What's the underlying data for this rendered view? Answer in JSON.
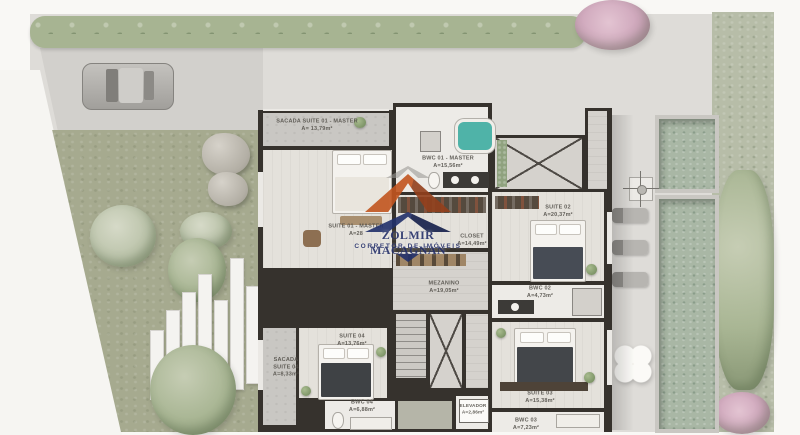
{
  "watermark": {
    "name": "ZOLMIR MACAGNAN",
    "subtitle": "CORRETOR DE IMÓVEIS",
    "brand_orange": "#c2551f",
    "brand_navy": "#22306b"
  },
  "plan": {
    "pool_teal": "#4fb3a8",
    "wall_color": "#36322d",
    "hedge_green": "#a7b492",
    "garden_green": "#a6aa8f"
  },
  "rooms": {
    "sacada01": {
      "name": "SACADA SUITE 01 - MASTER",
      "area": "A= 13,79m²"
    },
    "suite01": {
      "name": "SUITE 01 - MASTER",
      "area": "A=28"
    },
    "bwc01": {
      "name": "BWC 01 - MASTER",
      "area": "A=15,56m²"
    },
    "closet": {
      "name": "CLOSET",
      "area": "A=14,49m²"
    },
    "suite02": {
      "name": "SUITE 02",
      "area": "A=20,37m²"
    },
    "bwc02": {
      "name": "BWC 02",
      "area": "A=4,73m²"
    },
    "mezanino": {
      "name": "MEZANINO",
      "area": "A=19,05m²"
    },
    "suite04": {
      "name": "SUITE 04",
      "area": "A=13,76m²"
    },
    "sacada04": {
      "line1": "SACADA",
      "line2": "SUITE 04",
      "area": "A=8,33m²"
    },
    "bwc04": {
      "name": "BWC 04",
      "area": "A=6,88m²"
    },
    "elevador": {
      "name": "ELEVADOR",
      "area": "A=2,86m²"
    },
    "suite03": {
      "name": "SUITE 03",
      "area": "A=15,38m²"
    },
    "bwc03": {
      "name": "BWC 03",
      "area": "A=7,23m²"
    }
  }
}
